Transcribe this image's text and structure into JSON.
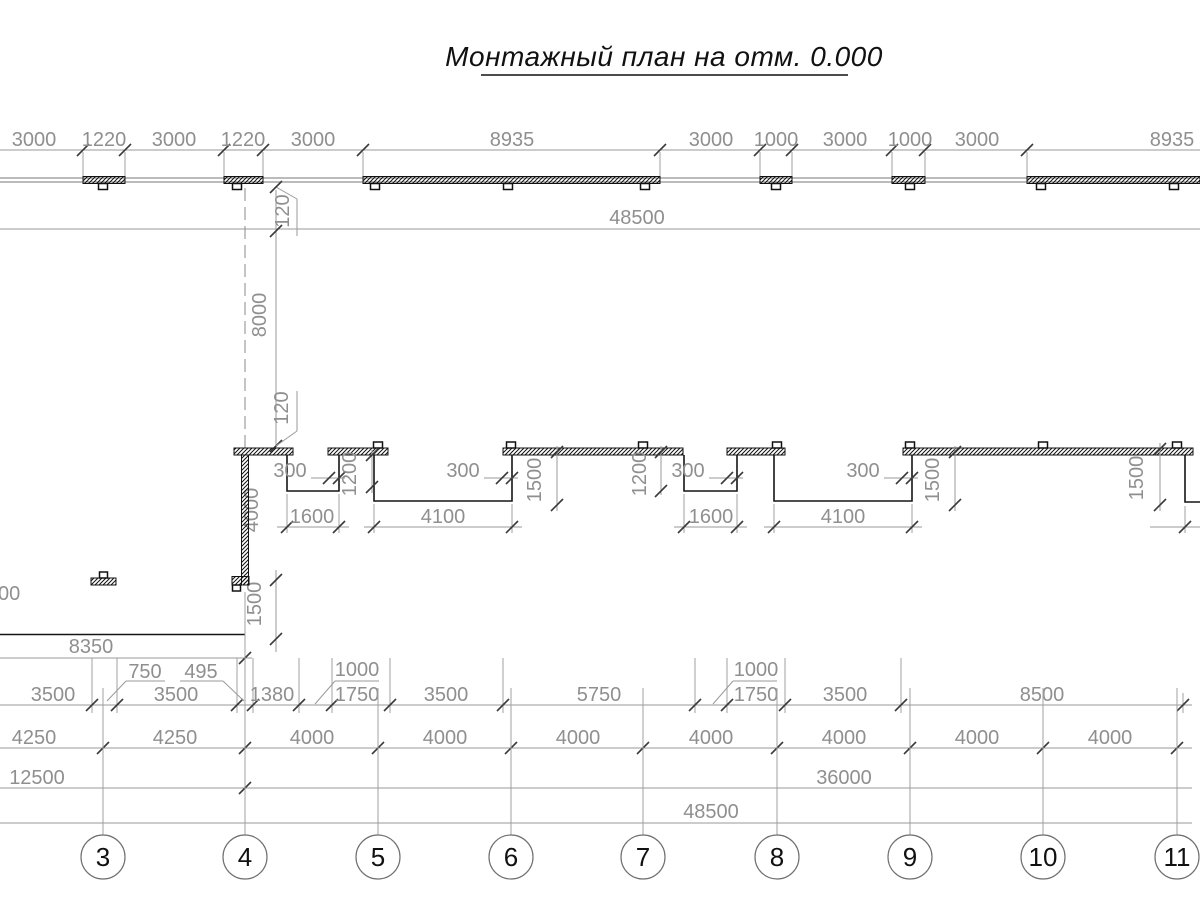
{
  "title": "Монтажный план на отм. 0.000",
  "colors": {
    "dim_text": "#8f8f8f",
    "wall": "#151515",
    "dim_line": "#9a9a9a"
  },
  "dimensions": {
    "top_row": [
      "3000",
      "1220",
      "3000",
      "1220",
      "3000",
      "8935",
      "3000",
      "1000",
      "3000",
      "1000",
      "3000",
      "8935"
    ],
    "overall_top": "48500",
    "left_vertical": {
      "offset_top": "120",
      "depth": "8000",
      "offset_mid": "120",
      "wall_len": "4000",
      "notch": "1500"
    },
    "middle": {
      "overlap": "300",
      "niche_small_w": "1600",
      "niche_small_d": "1200",
      "niche_large_w": "4100",
      "niche_large_d": "1500"
    },
    "left_block": {
      "cut": "00",
      "width": "8350"
    },
    "row1": [
      "3500",
      "750",
      "3500",
      "495",
      "1380",
      "1000",
      "1750",
      "3500",
      "5750",
      "1000",
      "1750",
      "3500",
      "8500"
    ],
    "row2": [
      "4250",
      "4250",
      "4000",
      "4000",
      "4000",
      "4000",
      "4000",
      "4000",
      "4000"
    ],
    "row3": [
      "12500",
      "36000"
    ],
    "overall_bottom": "48500"
  },
  "grid_bubbles": [
    "3",
    "4",
    "5",
    "6",
    "7",
    "8",
    "9",
    "10",
    "11"
  ]
}
